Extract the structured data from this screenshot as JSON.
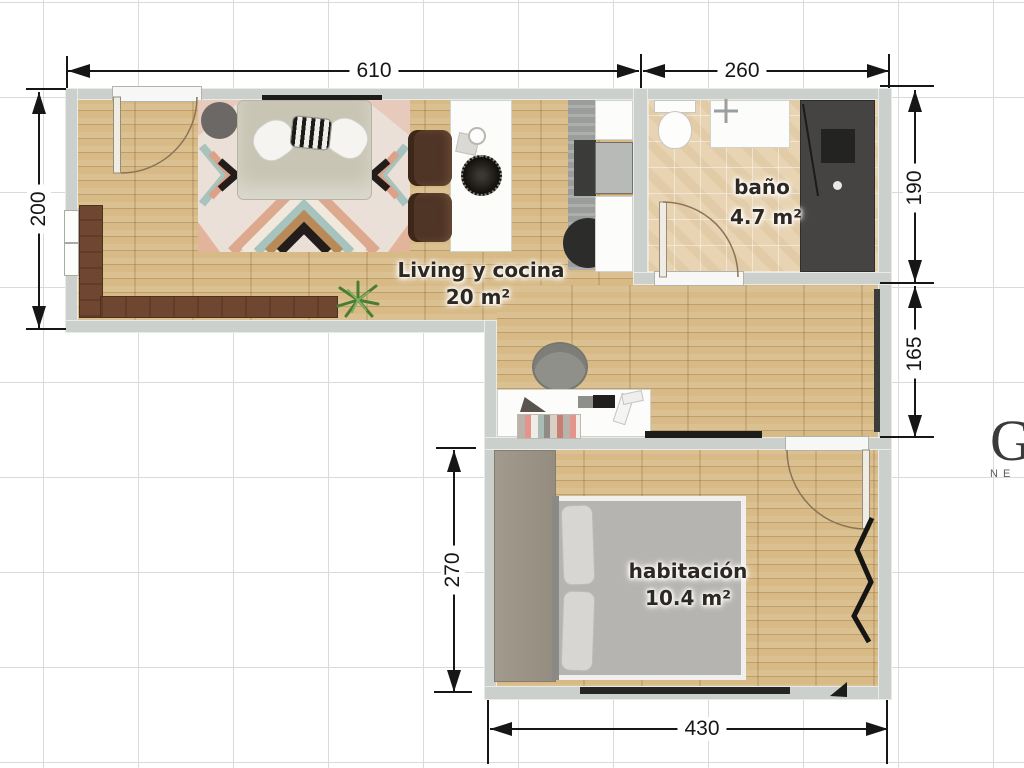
{
  "palette": {
    "wood": "#d7ba86",
    "wall": "#cbd0cc",
    "grid": "#dadada",
    "dim": "#161616",
    "label-color": "#2e2822",
    "bath-floor": "#e8d4b2",
    "dark-wood": "#6f4730"
  },
  "dims": {
    "top_living": "610",
    "top_bath": "260",
    "left": "200",
    "right_upper": "190",
    "right_lower": "165",
    "bedroom": "270",
    "bottom": "430"
  },
  "rooms": {
    "living": {
      "name": "Living y cocina",
      "area": "20 m²"
    },
    "bathroom": {
      "name": "baño",
      "area": "4.7 m²"
    },
    "bedroom": {
      "name": "habitación",
      "area": "10.4 m²"
    }
  },
  "watermark": {
    "initial": "G",
    "subtext": "NE"
  }
}
